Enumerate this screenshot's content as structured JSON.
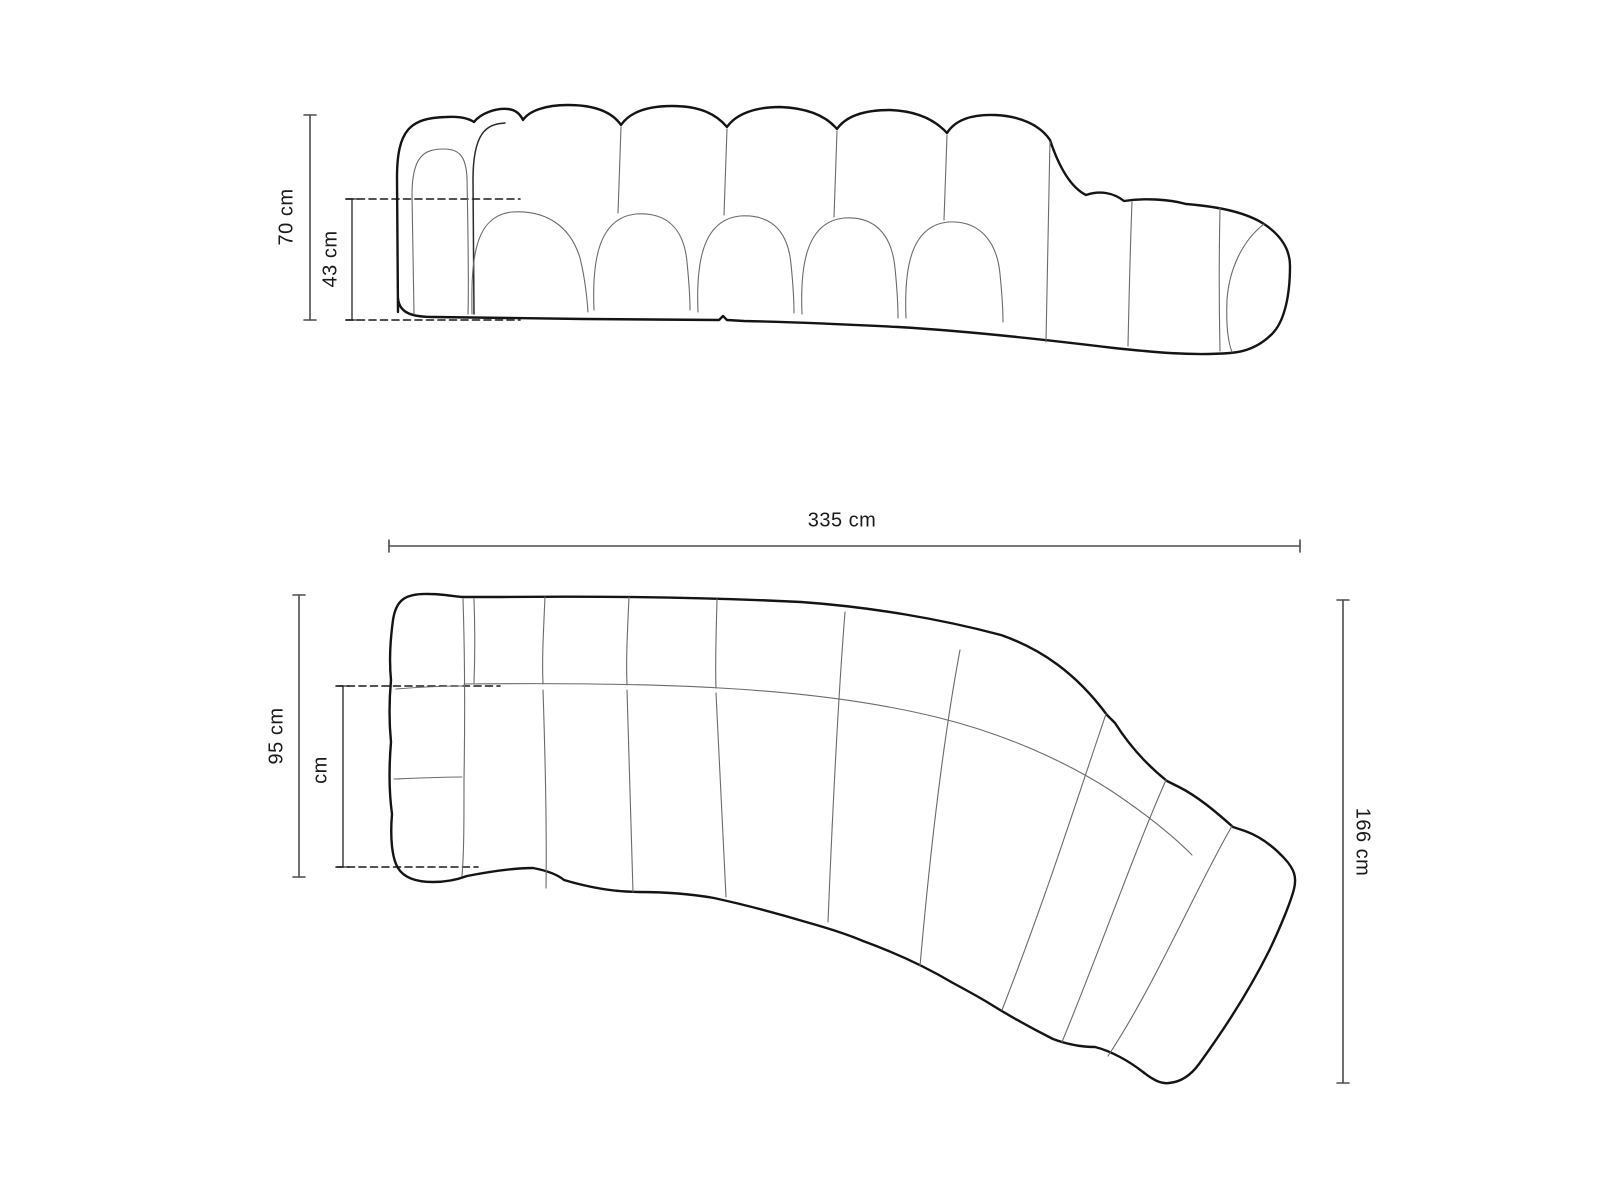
{
  "title": "Curved modular sofa technical dimension drawing",
  "colors": {
    "background": "#ffffff",
    "outline": "#141414",
    "seam": "#6a6a6a",
    "dimension_line": "#4d4d4d",
    "dashed_line": "#1a1a1a",
    "label_text": "#1a1a1a"
  },
  "side_view": {
    "name": "side-elevation",
    "dimensions": {
      "total_height": "70 cm",
      "seat_height": "43 cm"
    }
  },
  "plan_view": {
    "name": "top-plan",
    "dimensions": {
      "total_width": "335 cm",
      "total_depth": "95 cm",
      "seat_depth": "cm",
      "chaise_depth": "166 cm"
    }
  }
}
